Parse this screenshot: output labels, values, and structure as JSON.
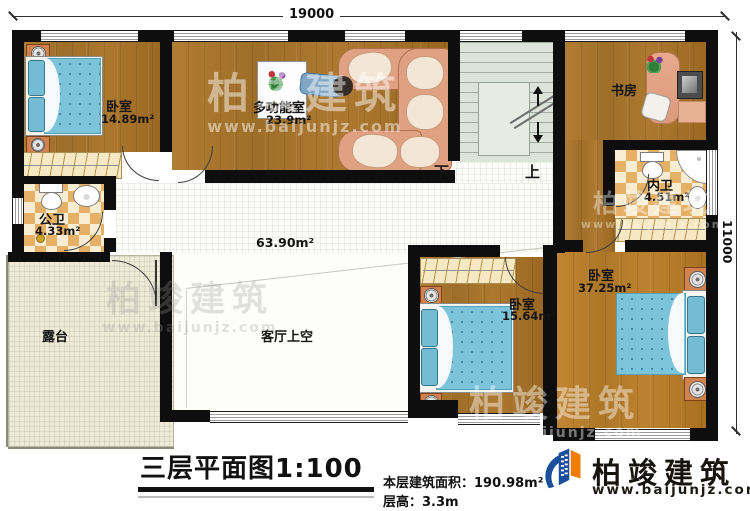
{
  "dimensions": {
    "top": "19000",
    "right": "11000"
  },
  "rooms": {
    "bedroom_nw": {
      "label": "卧室",
      "area": "14.89m²"
    },
    "multifunction": {
      "label": "多功能室",
      "area": "23.9m²"
    },
    "public_bath": {
      "label": "公卫",
      "area": "4.33m²"
    },
    "study": {
      "label": "书房"
    },
    "inner_bath": {
      "label": "内卫",
      "area": "4.51m²"
    },
    "corridor": {
      "area": "63.90m²"
    },
    "terrace": {
      "label": "露台"
    },
    "living_void": {
      "label": "客厅上空"
    },
    "bedroom_s": {
      "label": "卧室",
      "area": "15.64m²"
    },
    "bedroom_se": {
      "label": "卧室",
      "area": "37.25m²"
    }
  },
  "stairs": {
    "down": "下",
    "up": "上"
  },
  "footer": {
    "title": "三层平面图1:100",
    "area_line": "本层建筑面积：190.98m²",
    "floor_height_line": "层高：3.3m"
  },
  "brand": {
    "name": "柏竣建筑",
    "url": "www.baijunjz.com"
  },
  "colors": {
    "wall": "#0e0e0e",
    "wood": "#a9762d",
    "tile": "#e6b166",
    "stair": "#dce3d8",
    "bed": "#7cc4da",
    "brand_blue": "#1c4e9c",
    "brand_orange": "#f07d00"
  }
}
